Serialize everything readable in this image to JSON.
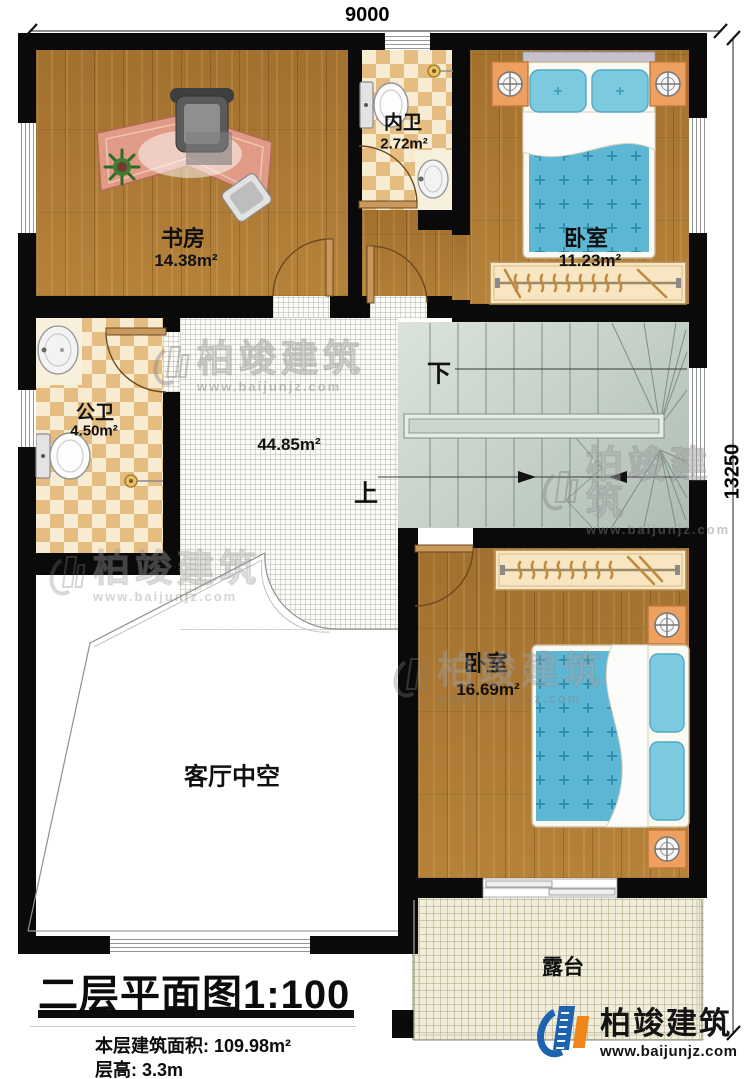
{
  "dimensions": {
    "top": "9000",
    "right": "13250"
  },
  "rooms": {
    "study": {
      "name": "书房",
      "area": "14.38m²"
    },
    "inner_bath": {
      "name": "内卫",
      "area": "2.72m²"
    },
    "bedroom_top": {
      "name": "卧室",
      "area": "11.23m²"
    },
    "public_bath": {
      "name": "公卫",
      "area": "4.50m²"
    },
    "hall": {
      "area": "44.85m²"
    },
    "bedroom_bottom": {
      "name": "卧室",
      "area": "16.69m²"
    },
    "living_void": {
      "name": "客厅中空"
    },
    "terrace": {
      "name": "露台"
    }
  },
  "stairs": {
    "down": "下",
    "up": "上"
  },
  "title": {
    "name": "二层平面图",
    "scale": "1:100",
    "area_line": "本层建筑面积: 109.98m²",
    "height_line": "层高: 3.3m"
  },
  "watermark": {
    "brand": "柏竣建筑",
    "url": "www.baijunjz.com"
  },
  "footer_logo": {
    "brand": "柏竣建筑",
    "url": "www.baijunjz.com"
  },
  "colors": {
    "brand_blue": "#1e63b0",
    "brand_orange": "#f08519",
    "wall": "#0a0a0a",
    "bed": "#5db7d5"
  }
}
